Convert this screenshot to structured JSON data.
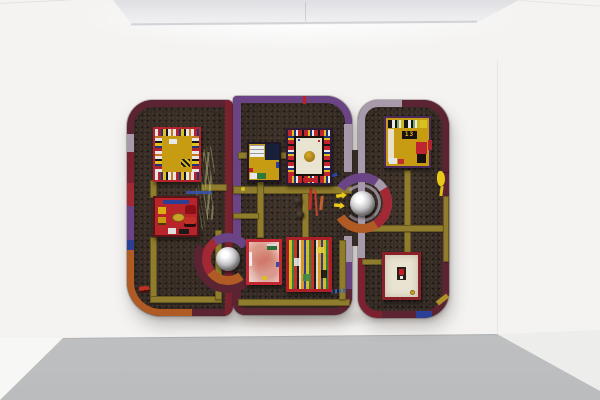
{
  "scene": {
    "setting": "white gallery interior with recessed ceiling light panel, white back wall and grey concrete floor",
    "colors": {
      "wall": "#f4f3f2",
      "floor": "#c7c7c9",
      "fixture": "#e9e9eb"
    }
  },
  "artwork": {
    "description": "large three-part mixed-media wall relief of rounded dark game-board shapes edged in coloured bands, crossed by olive-gold roads, with chrome dome knobs and eight collaged miniature boards",
    "colors": {
      "ground": "#342a23",
      "road": "#8f7c2c",
      "purple": "#6a4484",
      "lavender": "#a79aab",
      "maroon": "#5c2433",
      "dark_red": "#7c2130",
      "red": "#a22833",
      "orange": "#b05a24",
      "blue": "#2c3f97",
      "gold": "#b09028",
      "dome": "#d9d9db",
      "panel_red": "#b5242e",
      "mustard": "#c89c12",
      "ivory": "#e9e3d1",
      "pink": "#ecd3c8"
    },
    "sections": [
      {
        "name": "left",
        "panels": [
          "sticker-ring game board",
          "toy-car board"
        ]
      },
      {
        "name": "middle",
        "panels": [
          "small collage board",
          "ivory tray board with gold blob",
          "pink photo panel",
          "dense sticker mosaic panel"
        ]
      },
      {
        "name": "right",
        "panels": [
          "yellow numbered board",
          "ivory panel with small red object and coin"
        ]
      }
    ],
    "domes": 2,
    "labels": {
      "board_number": "13"
    }
  }
}
